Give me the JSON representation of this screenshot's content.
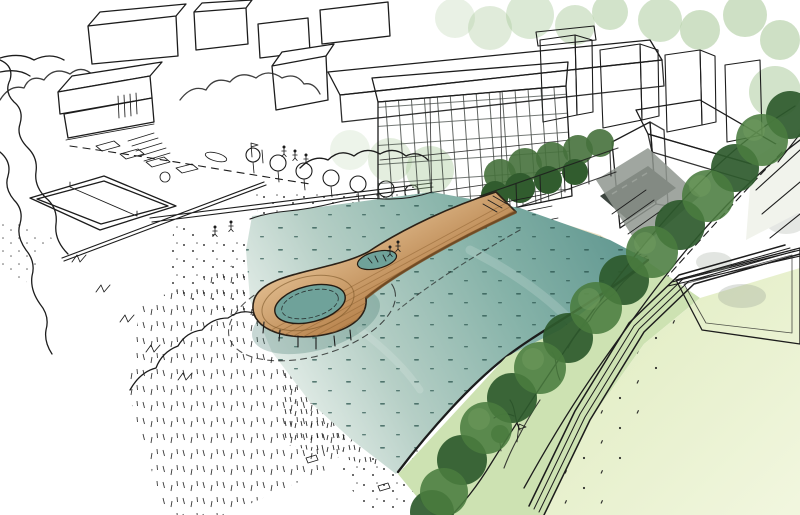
{
  "scene": {
    "type": "hand-drawn architectural concept sketch, aerial perspective",
    "style": "left half black-and-white line sketch fading into watercolor-rendered right half",
    "regions": [
      "sketched-city-blocks",
      "sketched-tree-canopies",
      "stepped-terrace-building",
      "beach-promenade",
      "beach-volleyball-court",
      "parked-cars-and-crosswalk",
      "dune-grass-field",
      "sandy-beach",
      "lagoon-water",
      "looped-timber-pier",
      "swimming-holes-in-pier",
      "glass-facade-slab-building",
      "courtyard-towers",
      "green-trellis-hedge",
      "shore-revetment-steps",
      "tree-lined-avenue",
      "waterside-green-bank",
      "big-lawn",
      "paved-court",
      "multi-line-footpath",
      "path-fork",
      "tiny-people-figures"
    ]
  },
  "palette": {
    "ink": "#1c1c1c",
    "paper": "#ffffff",
    "water_deep": "#6fa29a",
    "water_mid": "#85b2a8",
    "water_pale": "#c9ddd5",
    "sand_cream": "#efe7cf",
    "wood_light": "#e0bb8d",
    "wood_mid": "#c austere",
    "wood_dark": "#8c6234",
    "tree_dark": "#2e5a2d",
    "tree_mid": "#4a7c3f",
    "tree_light": "#6f9c5e",
    "tree_pale": "#a6c796",
    "hedge_green": "#46713c",
    "bank_green": "#cde2b2",
    "lawn": "#ebf3d3",
    "court_cream": "#f2eed8",
    "facade_glass": "#9fb0a8",
    "tower_light": "#c3cdcd",
    "tower_dark": "#93a2a4",
    "road_gray": "#8f968f",
    "ground_dark": "#3c453f",
    "building_white": "#f5f7f3"
  }
}
